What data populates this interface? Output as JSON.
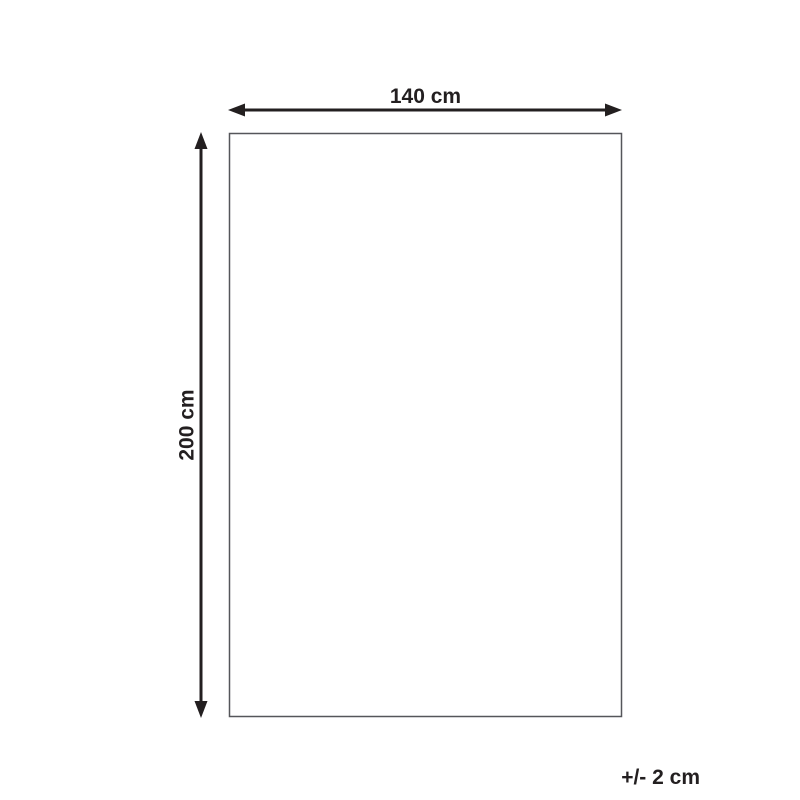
{
  "diagram": {
    "width_label": "140 cm",
    "height_label": "200 cm",
    "tolerance_label": "+/- 2 cm",
    "colors": {
      "background": "#ffffff",
      "arrow_and_text": "#231f20",
      "outline_stroke": "#55565a"
    }
  }
}
